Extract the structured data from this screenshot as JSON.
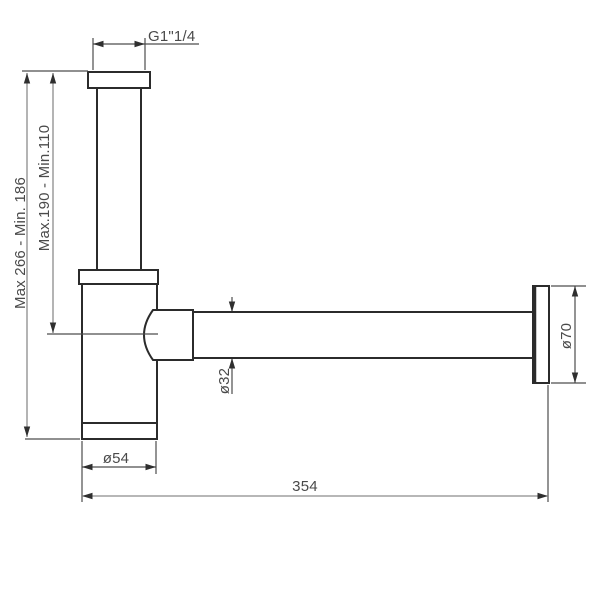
{
  "drawing": {
    "labels": {
      "thread": "G1\"1/4",
      "height_overall": "Max 266 - Min. 186",
      "height_inlet": "Max.190 - Min.110",
      "pipe_diameter": "ø32",
      "body_diameter": "ø54",
      "rosette_diameter": "ø70",
      "length": "354"
    },
    "colors": {
      "background": "#ffffff",
      "outline": "#2b2b2b",
      "extension": "#4d4d4d",
      "dimension": "#8c8c8c",
      "arrowhead": "#2f2f2f",
      "text": "#4a4a4a"
    }
  }
}
